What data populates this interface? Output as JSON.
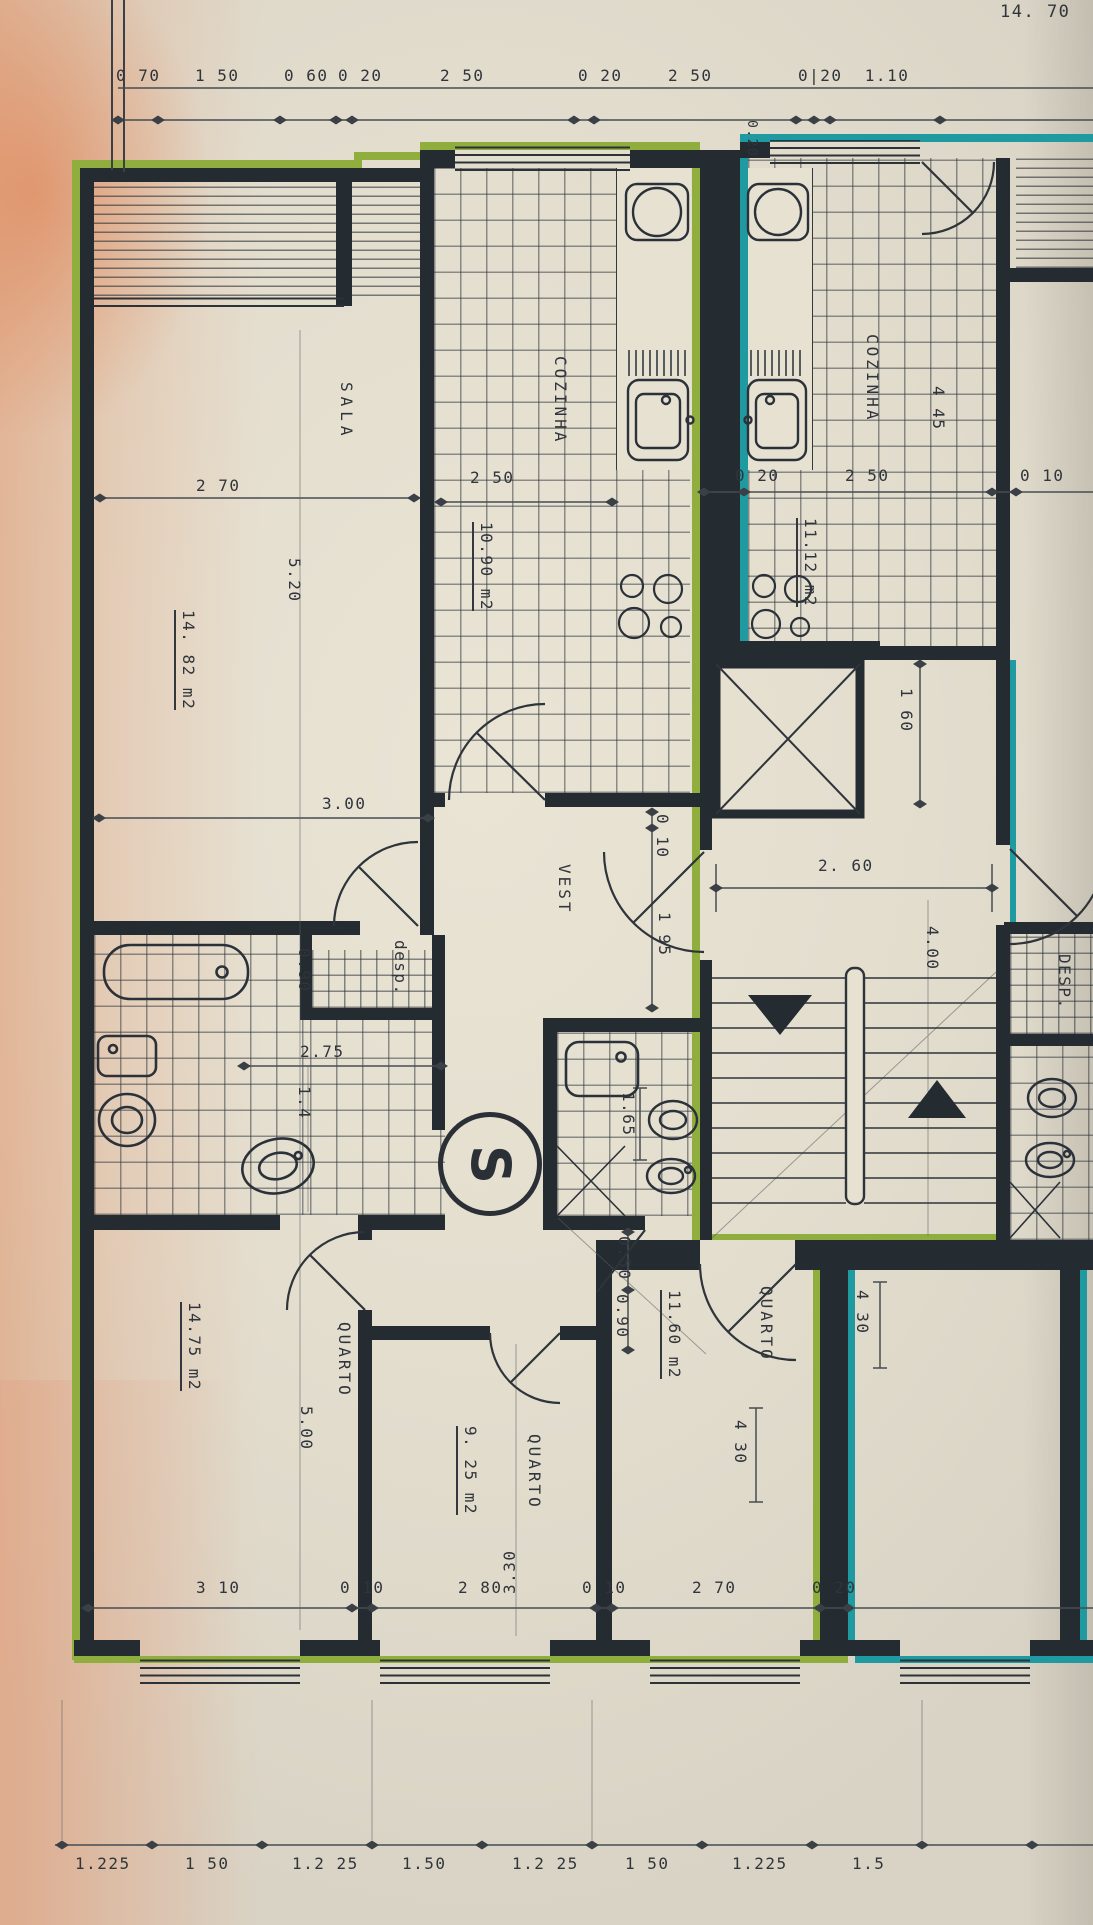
{
  "plan": {
    "overall_width": "14. 70",
    "unit_mark": "S",
    "top_chain": {
      "c0": "0 70",
      "c1": "1 50",
      "c2": "0 60",
      "c3": "0 20",
      "c4": "2 50",
      "c5": "0 20",
      "c6": "2 50",
      "c7": "0|20  1.10",
      "party": "0.20"
    },
    "rooms": {
      "sala": {
        "name": "SALA",
        "width": "2 70",
        "depth": "5.20",
        "area": "14. 82 m2",
        "width2": "3.00"
      },
      "coz_l": {
        "name": "COZINHA",
        "width": "2 50",
        "area": "10.90 m2"
      },
      "coz_r": {
        "name": "COZINHA",
        "depth": "4 45",
        "c0": "0 20",
        "c1": "2 50",
        "c2": "0 10",
        "area": "11.12 m2",
        "niche": "1 60"
      },
      "vest": {
        "name": "VEST",
        "d1": "0 10",
        "d2": "1 95"
      },
      "desp": {
        "name": "desp.",
        "width": "0.90"
      },
      "bath": {
        "len": "2.75",
        "wid": "1.4"
      },
      "wc": {
        "len": "1.65",
        "d1": "0.50",
        "d2": "0.90"
      },
      "core": {
        "landing": "2. 60",
        "depth": "4.00"
      },
      "desp_r": {
        "name": "DESP."
      },
      "q1": {
        "name": "QUARTO",
        "depth": "5.00",
        "area": "14.75 m2"
      },
      "q2": {
        "name": "QUARTO",
        "area": "9. 25 m2",
        "depth": "3.30"
      },
      "q3": {
        "name": "QUARTO",
        "area": "11.60 m2",
        "depth": "4 30"
      },
      "q4": {
        "depth": "4 30"
      }
    },
    "bottom_chain": {
      "b0": "3 10",
      "b1": "0 10",
      "b2": "2 80",
      "b3": "0 10",
      "b4": "2 70",
      "b5": "0 20"
    },
    "scale_chain": {
      "s0": "1.225",
      "s1": "1 50",
      "s2": "1.2 25",
      "s3": "1.50",
      "s4": "1.2 25",
      "s5": "1 50",
      "s6": "1.225",
      "s7": "1.5"
    },
    "colors": {
      "highlight_left": "#8fae3e",
      "highlight_right": "#1f9aa0",
      "wall": "#242b31",
      "ink": "#30353b"
    }
  }
}
